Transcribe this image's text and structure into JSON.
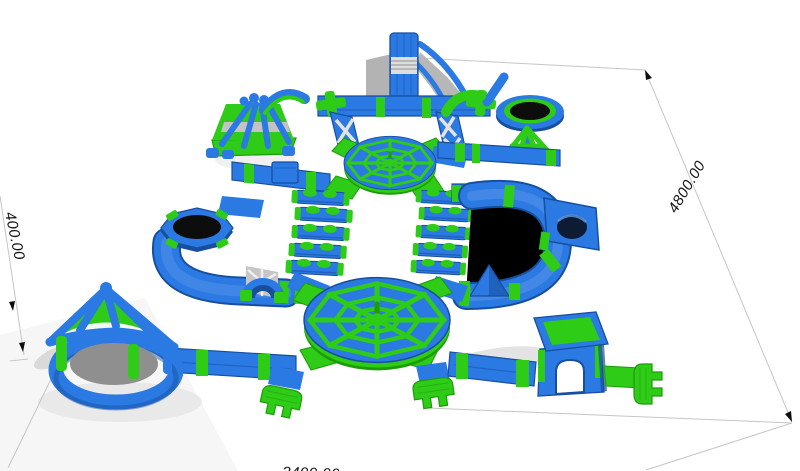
{
  "dimension_labels": {
    "right_side": "4800.00",
    "left_offset": "400.00",
    "bottom_partial": "3400.00"
  },
  "colors": {
    "blue": "#2b79e2",
    "blue_dark": "#174f9f",
    "blue_light": "#6fa7f2",
    "green": "#2ecb17",
    "green_dark": "#1d9c0a",
    "green_light": "#55e93b",
    "gray": "#b3b3b3",
    "gray_light": "#cfcfcf",
    "shadow": "#e9e9e9",
    "black": "#0d0d0d",
    "line": "#c6c6c6",
    "background": "#ffffff"
  }
}
